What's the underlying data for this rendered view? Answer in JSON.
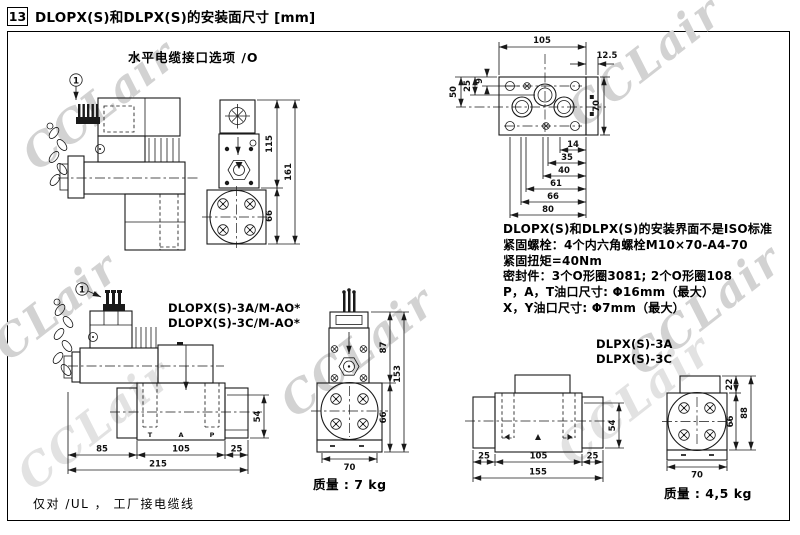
{
  "header": {
    "section_number": "13",
    "title": "DLOPX(S)和DLPX(S)的安装面尺寸 [mm]"
  },
  "watermark": {
    "text": "CCLair"
  },
  "cable_option": {
    "caption": "水平电缆接口选项 /O",
    "callout": "1"
  },
  "front_view_top": {
    "dim_115": "115",
    "dim_161": "161",
    "dim_66": "66"
  },
  "mounting_face": {
    "dim_105": "105",
    "dim_12_5": "12.5",
    "dim_9": "9",
    "dim_25": "25",
    "dim_50": "50",
    "dim_70": "70",
    "dim_14": "14",
    "dim_35": "35",
    "dim_40": "40",
    "dim_61": "61",
    "dim_66": "66",
    "dim_80": "80"
  },
  "spec_notes": {
    "lines": [
      "DLOPX(S)和DLPX(S)的安装界面不是ISO标准",
      "紧固螺栓：4个内六角螺栓M10×70-A4-70",
      "紧固扭矩=40Nm",
      "密封件：3个O形圈3081; 2个O形圈108",
      "P，A，T油口尺寸: Φ16mm（最大）",
      "X，Y油口尺寸: Φ7mm（最大）"
    ]
  },
  "dlopx_side_view": {
    "callout": "1",
    "models": [
      "DLOPX(S)-3A/M-AO*",
      "DLOPX(S)-3C/M-AO*"
    ],
    "dim_85": "85",
    "dim_105": "105",
    "dim_25": "25",
    "dim_215": "215",
    "dim_54": "54",
    "ports": {
      "t": "T",
      "a": "A",
      "p": "P"
    }
  },
  "dlopx_front_view": {
    "dim_87": "87",
    "dim_153": "153",
    "dim_66": "66",
    "dim_70": "70",
    "mass": "质量 : 7 kg"
  },
  "dlpx_views": {
    "models": [
      "DLPX(S)-3A",
      "DLPX(S)-3C"
    ],
    "side": {
      "dim_25_left": "25",
      "dim_105": "105",
      "dim_25_right": "25",
      "dim_155": "155",
      "dim_54": "54"
    },
    "front": {
      "dim_22": "22",
      "dim_88": "88",
      "dim_66": "66",
      "dim_70": "70"
    },
    "mass": "质量 : 4,5 kg"
  },
  "footer_note": "仅对 /UL ， 工厂接电缆线"
}
